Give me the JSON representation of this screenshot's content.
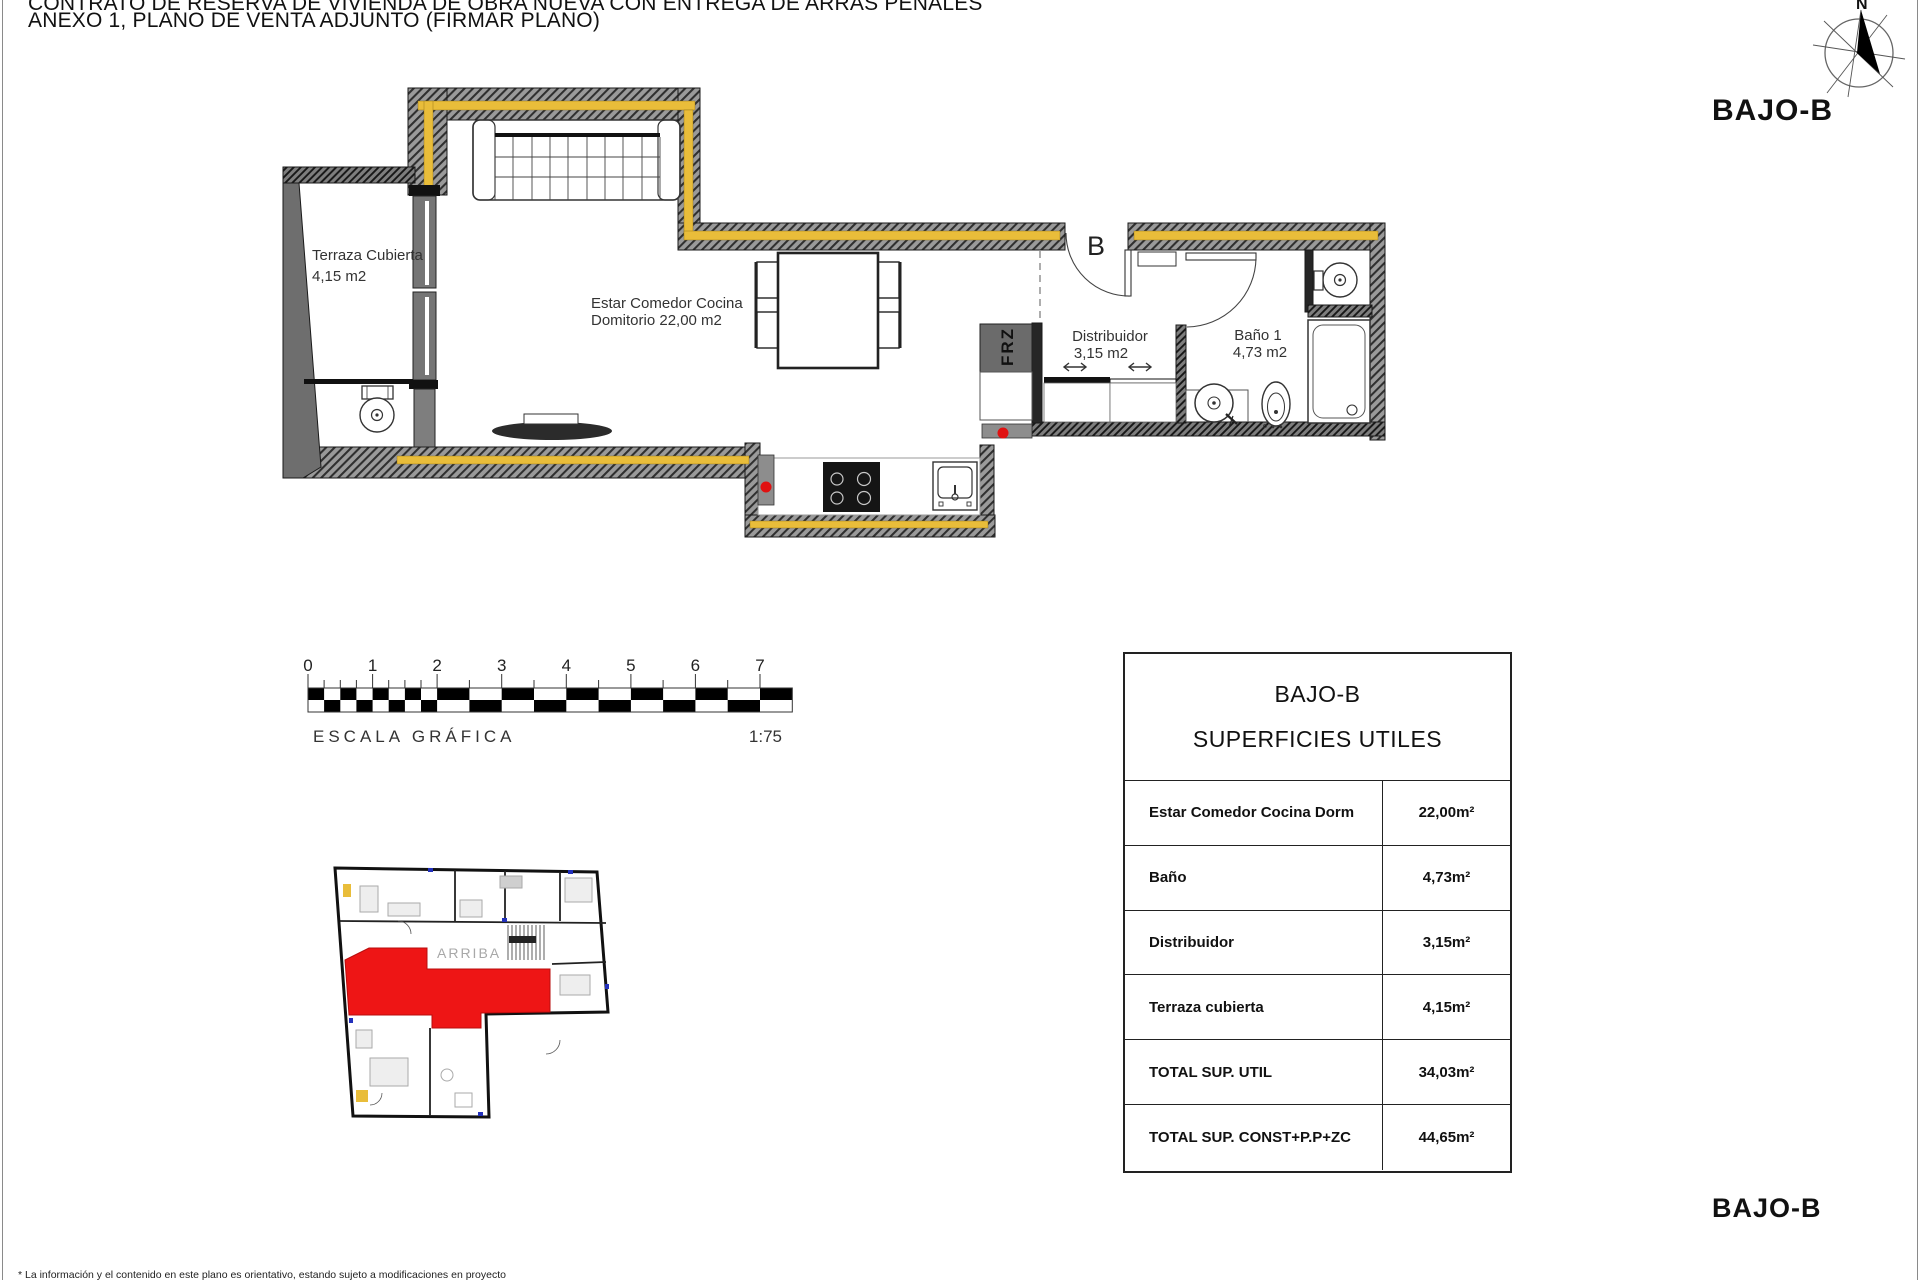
{
  "header": {
    "line1": "CONTRATO DE RESERVA DE VIVIENDA DE OBRA NUEVA CON ENTREGA DE ARRAS PENALES",
    "line2": "ANEXO 1, PLANO DE VENTA ADJUNTO (FIRMAR PLANO)"
  },
  "labels": {
    "unit_top": "BAJO-B",
    "unit_bottom": "BAJO-B"
  },
  "compass": {
    "north_label": "N"
  },
  "floor_plan": {
    "terraza": {
      "name": "Terraza Cubierta",
      "area": "4,15 m2"
    },
    "estar": {
      "line1": "Estar Comedor Cocina",
      "line2": "Domitorio 22,00 m2"
    },
    "distribuidor": {
      "name": "Distribuidor",
      "area": "3,15 m2"
    },
    "bano": {
      "name": "Baño 1",
      "area": "4,73 m2"
    },
    "entrance_door_label": "B",
    "freezer_label": "FRZ"
  },
  "scale_bar": {
    "ticks": [
      "0",
      "1",
      "2",
      "3",
      "4",
      "5",
      "6",
      "7"
    ],
    "caption": "ESCALA GRÁFICA",
    "ratio": "1:75"
  },
  "site_plan": {
    "stair_label": "ARRIBA"
  },
  "table": {
    "title1": "BAJO-B",
    "title2": "SUPERFICIES UTILES",
    "rows": [
      {
        "label": "Estar Comedor Cocina Dorm",
        "value": "22,00m²"
      },
      {
        "label": "Baño",
        "value": "4,73m²"
      },
      {
        "label": "Distribuidor",
        "value": "3,15m²"
      },
      {
        "label": "Terraza cubierta",
        "value": "4,15m²"
      },
      {
        "label": "TOTAL SUP. UTIL",
        "value": "34,03m²"
      },
      {
        "label": "TOTAL SUP. CONST+P.P+ZC",
        "value": "44,65m²"
      }
    ]
  },
  "footnote": "* La información y el contenido en este plano es orientativo, estando sujeto a modificaciones en proyecto",
  "colors": {
    "insulation_yellow": "#E9BD3A",
    "wall_gray": "#989898",
    "highlight_red": "#EE1515",
    "freezer_gray": "#6B6B6B"
  }
}
